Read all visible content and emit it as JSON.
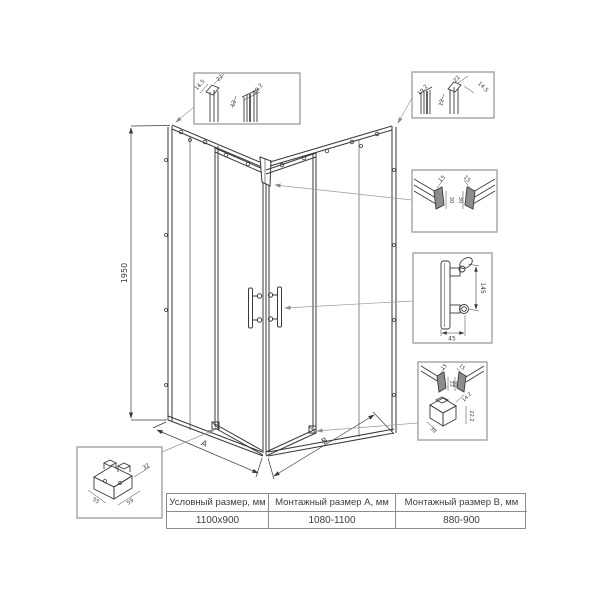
{
  "dims": {
    "height": "1950",
    "a": "A",
    "b": "B"
  },
  "callout_tl": {
    "d1": "14.5",
    "d2": "22",
    "d3": "12",
    "d4": "19.2"
  },
  "callout_tr": {
    "d1": "19.2",
    "d2": "12",
    "d3": "22",
    "d4": "14.5"
  },
  "callout_rails": {
    "w1": "15",
    "h1": "30",
    "w2": "15",
    "h2": "30"
  },
  "callout_handle": {
    "length": "145",
    "width": "45"
  },
  "callout_bottom": {
    "w1": "15",
    "h1": "22",
    "w2": "15",
    "h2": "22",
    "b1": "14.2",
    "b2": "22.2",
    "b3": "30"
  },
  "callout_bracket": {
    "d1": "55",
    "d2": "59",
    "d3": "32"
  },
  "table": {
    "headers": [
      "Условный размер, мм",
      "Монтажный размер А, мм",
      "Монтажный размер В, мм"
    ],
    "values": [
      "1100x900",
      "1080-1100",
      "880-900"
    ]
  },
  "colors": {
    "line": "#3a3a3a",
    "box": "#a3a3a3",
    "leader": "#9a9a9a",
    "table_border": "#8c8c8c"
  }
}
